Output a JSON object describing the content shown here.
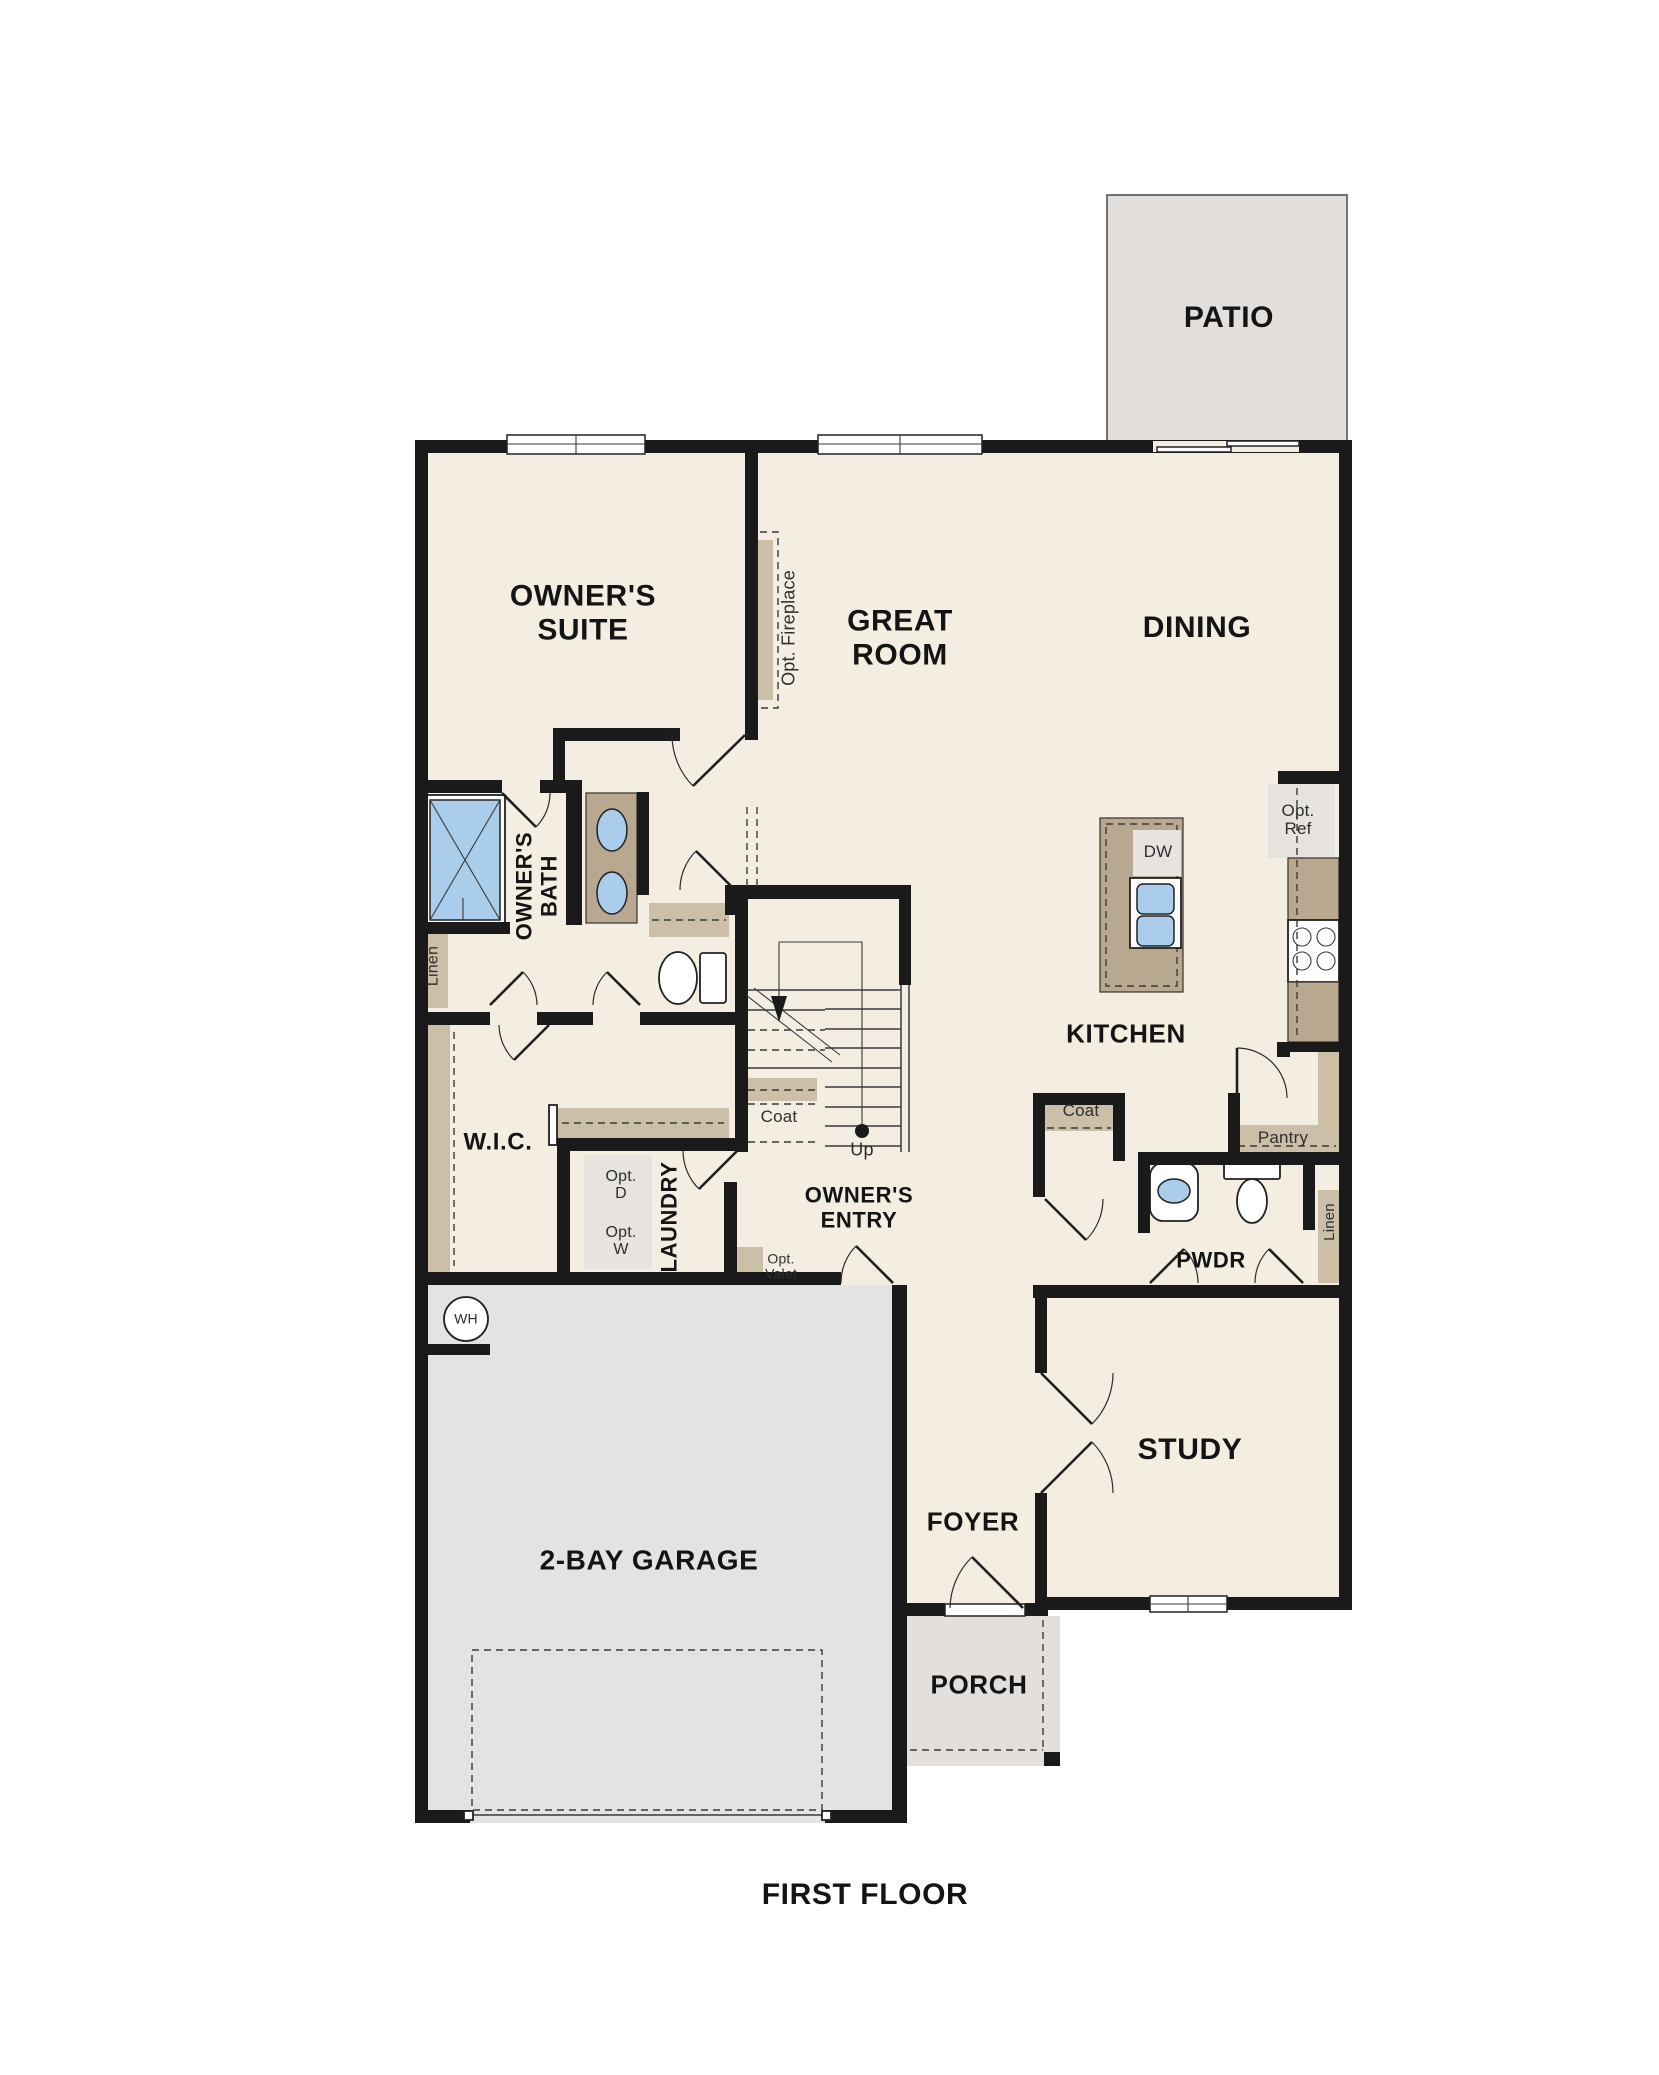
{
  "title": "FIRST FLOOR",
  "rooms": {
    "patio": "PATIO",
    "owners_suite": "OWNER'S\nSUITE",
    "great_room": "GREAT\nROOM",
    "dining": "DINING",
    "kitchen": "KITCHEN",
    "owners_bath": "OWNER'S\nBATH",
    "wic": "W.I.C.",
    "laundry": "LAUNDRY",
    "owners_entry": "OWNER'S\nENTRY",
    "pwdr": "PWDR",
    "study": "STUDY",
    "foyer": "FOYER",
    "garage": "2-BAY GARAGE",
    "porch": "PORCH"
  },
  "features": {
    "opt_fireplace": "Opt. Fireplace",
    "linen_left": "Linen",
    "linen_right": "Linen",
    "coat_under_stairs": "Coat",
    "coat_closet": "Coat",
    "pantry": "Pantry",
    "up": "Up",
    "dw": "DW",
    "opt_ref": "Opt.\nRef",
    "opt_dryer": "Opt.\nD",
    "opt_washer": "Opt.\nW",
    "opt_valet": "Opt.\nValet",
    "water_heater": "WH"
  },
  "colors": {
    "floor": "#f3eee1",
    "hardscape": "#e2dfdc",
    "garage_floor": "#e5e3e1",
    "cabinetry": "#b7a88f",
    "shelving": "#cbbfa7",
    "fixture_blue": "#a9cdeb",
    "wall": "#1a1a1a"
  }
}
